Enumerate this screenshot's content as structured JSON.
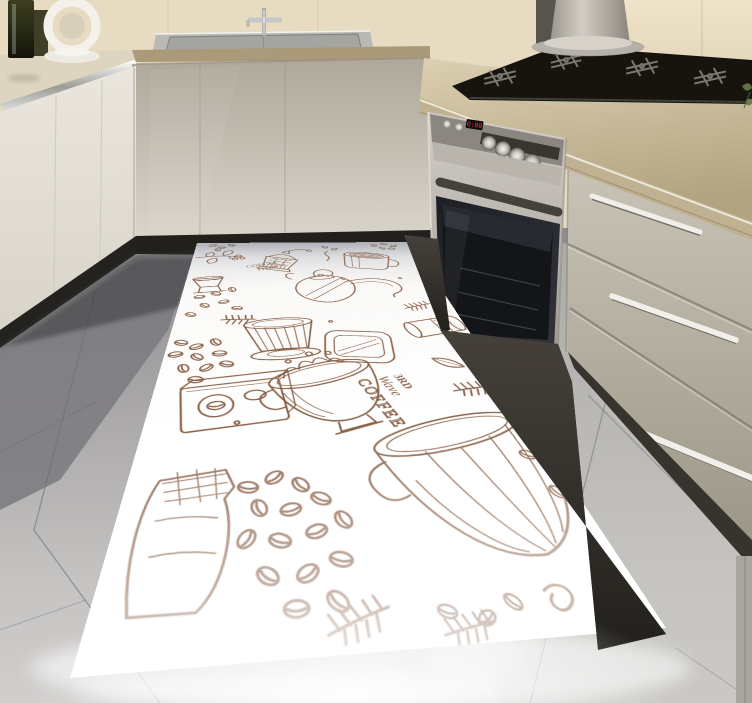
{
  "scene": {
    "kind": "kitchen-interior-photo",
    "description": "Modern beige kitchen corner with sink, gas cooktop, built-in oven and a white coffee-sketch floor mat on glossy grey tiles"
  },
  "palette": {
    "wall_beige": "#e7dbc1",
    "counter_cream": "#d9cdaf",
    "counter_edge_tan": "#ab9a79",
    "cabinet_left": "#ece8df",
    "cabinet_center": "#c3bcb0",
    "drawer_steel": "#b3ada0",
    "oven_door": "#1b1c20",
    "kick_dark": "#26241f",
    "floor_grey": "#b5b3b1",
    "rug_base": "#fdfdfc",
    "rug_ink": "#8a6148",
    "display_red": "#ff3642",
    "plant_green": "#5f7247"
  },
  "appliances": {
    "oven": {
      "display_value": "0:00",
      "small_knob_count": 2,
      "large_knob_count": 4
    },
    "cooktop": {
      "burner_count": 4
    },
    "hood": {
      "style": "flared-cylinder"
    },
    "sink": {
      "basin_count": 1
    },
    "drawers": {
      "handle_count": 3
    }
  },
  "rug": {
    "texts": {
      "coffee_time": [
        "COFFEE",
        "TIME"
      ],
      "third_wave": [
        "3RD",
        "Wave",
        "COFFEE"
      ]
    },
    "motifs": [
      "coffee-branch",
      "coffee-grinder",
      "mug",
      "gooseneck-kettle",
      "pour-over-dripper",
      "coffee-beans",
      "square-tray",
      "portafilter",
      "coffee-package",
      "splash-cup",
      "coffee-bag",
      "ribbed-cup",
      "sprigs",
      "leaf"
    ]
  }
}
